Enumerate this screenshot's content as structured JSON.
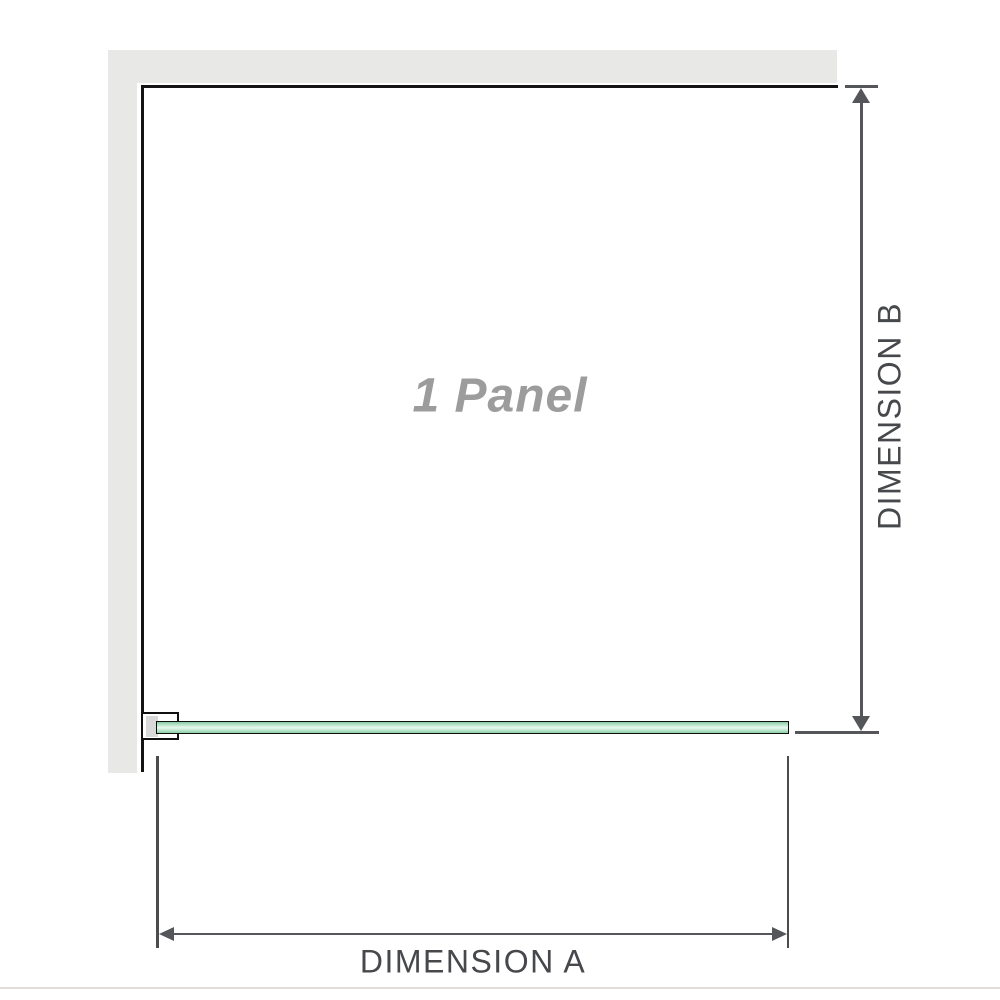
{
  "diagram": {
    "panel_label": "1 Panel",
    "dimension_a_label": "DIMENSION A",
    "dimension_b_label": "DIMENSION B",
    "colors": {
      "wall_fill": "#e8e8e7",
      "frame_line": "#141414",
      "glass_border": "#0e0e0e",
      "glass_green_dark": "#84c8a0",
      "glass_green_light": "#e7f7ee",
      "bracket_fill": "#ffffff",
      "bracket_pad": "#d9d9d9",
      "arrow_line": "#54565a",
      "extension_line": "#4b4c4e",
      "dimension_text": "#46484c",
      "panel_text": "#9c9c9c",
      "divider": "#dfddd5"
    }
  }
}
